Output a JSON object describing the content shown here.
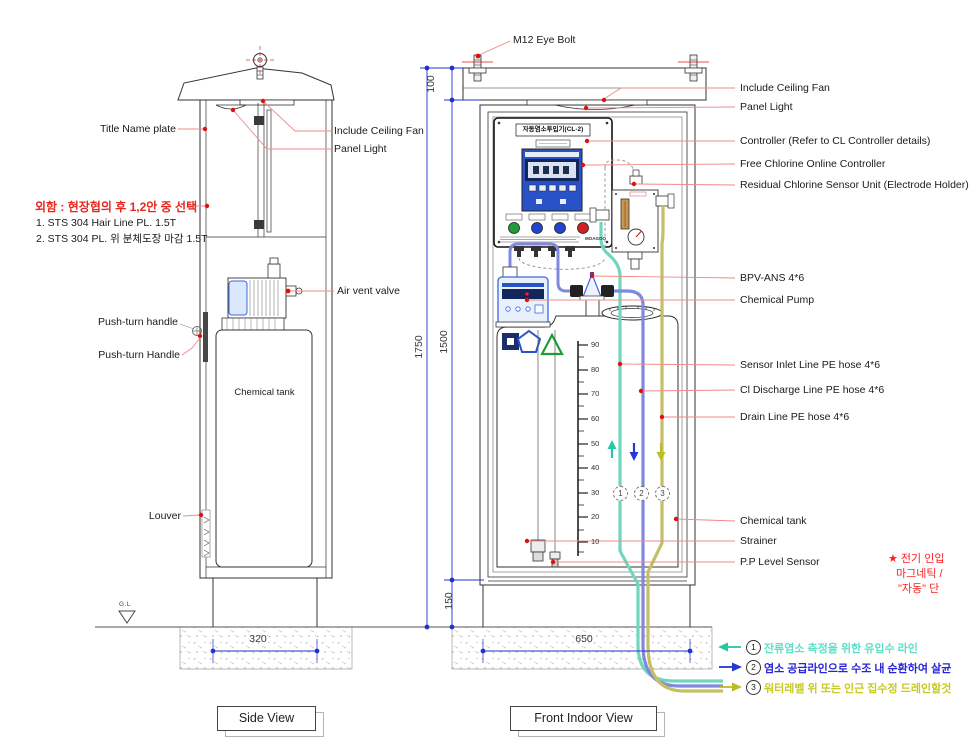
{
  "colors": {
    "leader_red": "#e88080",
    "dot_red": "#e01010",
    "dim_blue": "#2233cc",
    "hose_teal": "#72d6bf",
    "hose_blue": "#8089dd",
    "hose_yellow": "#c6bf66",
    "legend_teal": "#5fe0c5",
    "legend_blue": "#2626d8",
    "legend_yellow": "#c9c926",
    "note_red": "#ff1f1f"
  },
  "side_view": {
    "title": "Side View",
    "labels": {
      "title_name_plate": "Title Name plate",
      "enclosure_note": "외함 : 현장협의 후 1,2안 중 선택",
      "option1": "1. STS 304 Hair Line PL. 1.5T",
      "option2": "2. STS 304 PL. 위 분체도장 마감 1.5T",
      "include_ceiling_fan": "Include Ceiling Fan",
      "panel_light": "Panel Light",
      "air_vent_valve": "Air vent valve",
      "push_turn_handle_lower": "Push-turn handle",
      "push_turn_handle_upper": "Push-turn Handle",
      "chemical_tank": "Chemical tank",
      "louver": "Louver",
      "ground_level": "G.L"
    },
    "dimensions": {
      "base_width": "320"
    }
  },
  "front_view": {
    "title": "Front Indoor View",
    "eye_bolt_label": "M12 Eye Bolt",
    "dimensions": {
      "top": "100",
      "overall_height": "1750",
      "body_height": "1500",
      "base_height": "150",
      "base_width": "650"
    },
    "right_labels": [
      "Include Ceiling Fan",
      "Panel Light",
      "Controller (Refer to CL Controller details)",
      "Free Chlorine Online Controller",
      "Residual Chlorine Sensor Unit (Electrode Holder)",
      "BPV-ANS 4*6",
      "Chemical Pump",
      "Sensor Inlet Line PE hose 4*6",
      "Cl Discharge Line PE hose 4*6",
      "Drain Line PE hose 4*6",
      "Chemical tank",
      "Strainer",
      "P.P Level Sensor"
    ],
    "controller": {
      "title": "자동염소투입기(CL-2)",
      "brand": "MOAGOO"
    },
    "tank_scale": [
      "90",
      "80",
      "70",
      "60",
      "50",
      "40",
      "30",
      "20",
      "10"
    ],
    "hose_markers": [
      "1",
      "2",
      "3"
    ]
  },
  "legend": {
    "items": [
      {
        "num": "1",
        "text": "잔류염소 측정을 위한 유입수 라인"
      },
      {
        "num": "2",
        "text": "염소 공급라인으로 수조 내 순환하여 살균"
      },
      {
        "num": "3",
        "text": "워터레벨 위 또는 인근 집수정 드레인할것"
      }
    ]
  },
  "side_note": {
    "lines": [
      "★ 전기 인입",
      "마그네틱 /",
      "\"자동\" 단"
    ]
  }
}
